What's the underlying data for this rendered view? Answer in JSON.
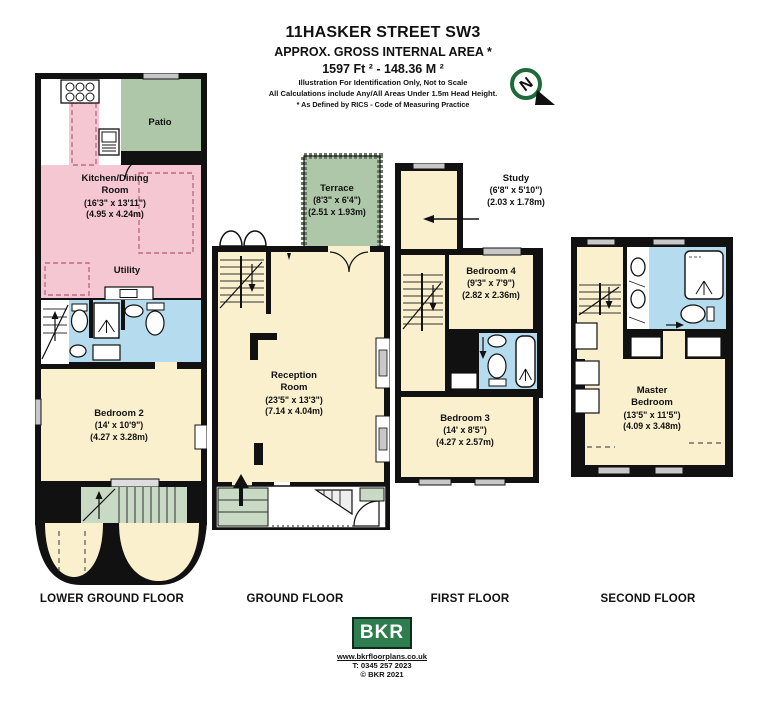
{
  "header": {
    "title": "11HASKER STREET SW3",
    "subtitle": "APPROX. GROSS INTERNAL AREA *",
    "area_line": "1597 Ft ²  -  148.36 M ²",
    "note1": "Illustration For Identification Only, Not to Scale",
    "note2": "All Calculations include Any/All Areas Under 1.5m Head Height.",
    "note3": "* As Defined by RICS - Code of Measuring Practice",
    "compass_n": "N"
  },
  "floors": {
    "lower_ground": {
      "label": "LOWER GROUND FLOOR",
      "patio": {
        "name": "Patio"
      },
      "kitchen": {
        "name": "Kitchen/Dining Room",
        "dims_ft": "(16'3\" x 13'11\")",
        "dims_m": "(4.95 x 4.24m)"
      },
      "utility": {
        "name": "Utility"
      },
      "bedroom2": {
        "name": "Bedroom 2",
        "dims_ft": "(14' x 10'9\")",
        "dims_m": "(4.27 x 3.28m)"
      }
    },
    "ground": {
      "label": "GROUND FLOOR",
      "terrace": {
        "name": "Terrace",
        "dims_ft": "(8'3\" x 6'4\")",
        "dims_m": "(2.51 x 1.93m)"
      },
      "reception": {
        "name": "Reception Room",
        "dims_ft": "(23'5\" x 13'3\")",
        "dims_m": "(7.14 x 4.04m)"
      }
    },
    "first": {
      "label": "FIRST FLOOR",
      "study": {
        "name": "Study",
        "dims_ft": "(6'8\" x 5'10\")",
        "dims_m": "(2.03 x 1.78m)"
      },
      "bedroom4": {
        "name": "Bedroom 4",
        "dims_ft": "(9'3\" x 7'9\")",
        "dims_m": "(2.82 x 2.36m)"
      },
      "bedroom3": {
        "name": "Bedroom 3",
        "dims_ft": "(14' x 8'5\")",
        "dims_m": "(4.27 x 2.57m)"
      }
    },
    "second": {
      "label": "SECOND FLOOR",
      "master": {
        "name": "Master Bedroom",
        "dims_ft": "(13'5\" x 11'5\")",
        "dims_m": "(4.09 x 3.48m)"
      }
    }
  },
  "footer": {
    "logo": "BKR",
    "website": "www.bkrfloorplans.co.uk",
    "phone": "T:  0345 257 2023",
    "copyright": "© BKR 2021"
  },
  "colors": {
    "room_cream": "#FAF0CE",
    "room_pink": "#F5C7D3",
    "room_blue": "#B5DCEE",
    "outdoor_green": "#AFC7A9",
    "stair_green": "#C9DAC4",
    "wall_black": "#111111",
    "logo_green": "#2E7D4F"
  }
}
